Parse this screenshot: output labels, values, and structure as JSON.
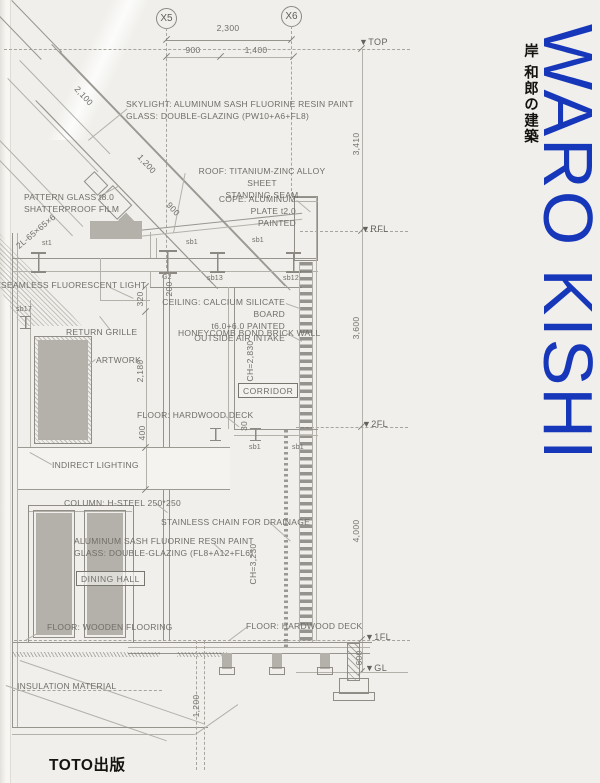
{
  "cover": {
    "title": "WARO KISHI",
    "title_jp": "岸 和郎の建築",
    "publisher": "TOTO出版"
  },
  "colors": {
    "accent_blue": "#1737bb",
    "paper": "#f0efeb"
  },
  "drawing": {
    "grid": {
      "x5": "X5",
      "x6": "X6"
    },
    "levels": {
      "top": "▼TOP",
      "rfl": "▼RFL",
      "fl2": "▼2FL",
      "fl1": "▼1FL",
      "gl": "▼GL"
    },
    "dims": {
      "w2300": "2,300",
      "w900": "900",
      "w1400": "1,400",
      "d2100": "2,100",
      "d1200": "1,200",
      "d900": "900",
      "v3410": "3,410",
      "v3600": "3,600",
      "v4000": "4,000",
      "v600": "600",
      "v320": "320",
      "v200": "200",
      "v2180": "2,180",
      "v400": "400",
      "v30": "30",
      "v1200": "1,200",
      "ch_upper": "CH=2,830",
      "ch_lower": "CH=3,230"
    },
    "beams": {
      "st1": "st1",
      "sb1_a": "sb1",
      "sb1_b": "sb1",
      "g2": "G2",
      "sb13": "sb13",
      "sb12": "sb12",
      "sb17": "sb17",
      "sb4a": "sb4A",
      "sb1_c": "sb1",
      "sb1_d": "sb1"
    },
    "rooms": {
      "corridor": "CORRIDOR",
      "dining": "DINING HALL"
    },
    "notes": {
      "skylight": "SKYLIGHT: ALUMINUM SASH FLUORINE RESIN PAINT\nGLASS: DOUBLE-GLAZING (PW10+A6+FL8)",
      "roof": "ROOF: TITANIUM-ZINC ALLOY SHEET\nSTANDING SEAM",
      "pattern_glass": "PATTERN GLASS t8.0\nSHATTERPROOF FILM",
      "cope": "COPE: ALUMINUM PLATE t2.0\nPAINTED",
      "angle_steel": "2L-65×65×6",
      "seamless_light": "SEAMLESS FLUORESCENT LIGHT",
      "ceiling": "CEILING: CALCIUM SILICATE BOARD\nt6.0+6.0 PAINTED\nOUTSIDE AIR INTAKE",
      "return_grille": "RETURN GRILLE",
      "honeycomb": "HONEYCOMB BOND BRICK WALL",
      "artwork": "ARTWORK",
      "floor_hw_mid": "FLOOR: HARDWOOD DECK",
      "indirect": "INDIRECT LIGHTING",
      "column": "COLUMN: H-STEEL 250*250",
      "chain": "STAINLESS CHAIN FOR DRAINAGE",
      "sash": "ALUMINUM SASH FLUORINE RESIN PAINT\nGLASS: DOUBLE-GLAZING (FL8+A12+FL6)",
      "floor_wood": "FLOOR: WOODEN FLOORING",
      "floor_hw_low": "FLOOR: HARDWOOD DECK",
      "insulation": "INSULATION MATERIAL"
    }
  }
}
